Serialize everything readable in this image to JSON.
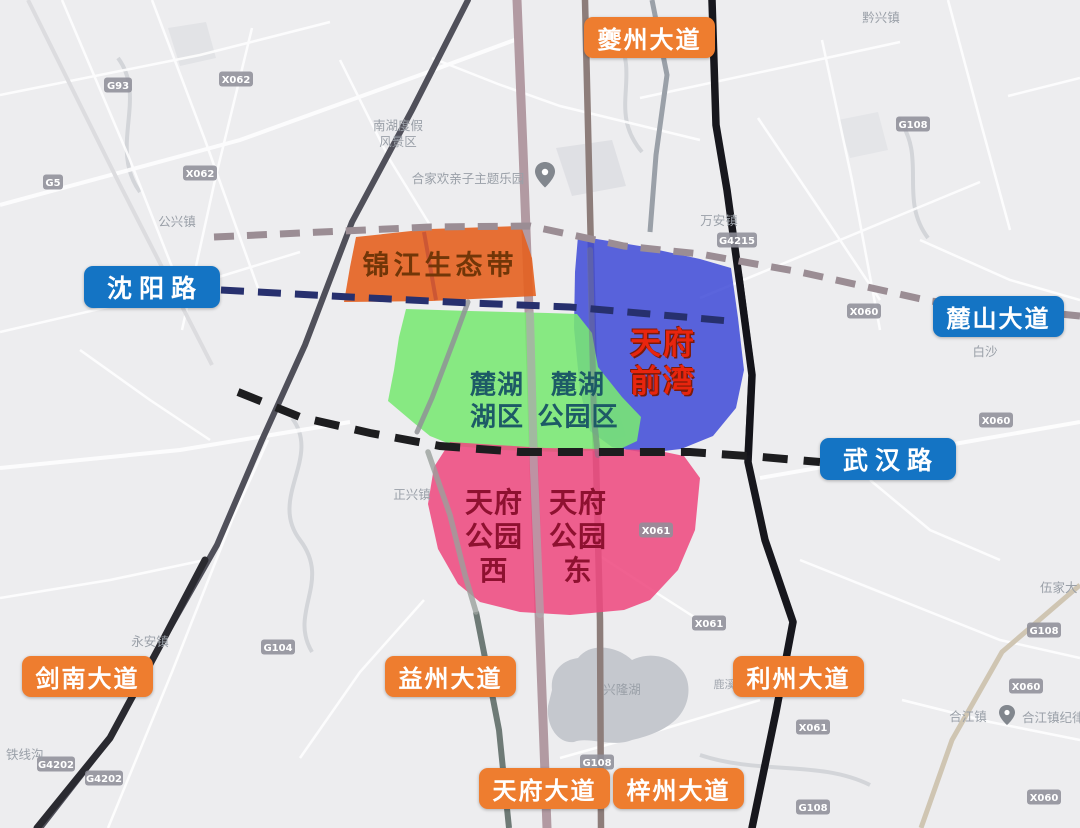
{
  "regions": {
    "jinjiang": {
      "name": "锦江生态带"
    },
    "qianwan": {
      "line1": "天府",
      "line2": "前湾"
    },
    "luhu_lake": {
      "line1": "麓湖",
      "line2": "湖区"
    },
    "luhu_park": {
      "line1": "麓湖",
      "line2": "公园区"
    },
    "park_west": {
      "line1": "天府",
      "line2": "公园",
      "line3": "西"
    },
    "park_east": {
      "line1": "天府",
      "line2": "公园",
      "line3": "东"
    }
  },
  "road_labels": {
    "kuizhou": "夔州大道",
    "shenyang": "沈阳路",
    "lushan": "麓山大道",
    "wuhan": "武汉路",
    "jiannan": "剑南大道",
    "yizhou": "益州大道",
    "lizhou": "利州大道",
    "tianfu": "天府大道",
    "zizhou": "梓州大道"
  },
  "towns": {
    "qianxing": "黔兴镇",
    "gongxing": "公兴镇",
    "wanan": "万安镇",
    "zhengxing": "正兴镇",
    "yongan": "永安镇",
    "hejiang": "合江镇",
    "baisha": "白沙",
    "tiexian": "铁线沟",
    "wujia": "伍家大"
  },
  "pois": {
    "theme_park": "合家欢亲子主题乐园",
    "nanhu_l1": "南湖度假",
    "nanhu_l2": "风景区",
    "hejiang_committee": "合江镇纪律检查",
    "xinglong_lake": "兴隆湖",
    "luxi_river": "鹿溪河"
  },
  "shields": {
    "g93": "G93",
    "x062": "X062",
    "g5": "G5",
    "g108": "G108",
    "g4215": "G4215",
    "x061": "X061",
    "x060": "X060",
    "g104": "G104",
    "g4202": "G4202"
  },
  "colors": {
    "orange_pill": "#ee7d2f",
    "blue_pill": "#1474c4",
    "region_orange": "#e4601f",
    "region_blue": "#3c48d6",
    "region_green": "#79e873",
    "region_pink": "#ee4a80",
    "dash_mauve": "#9b8d94",
    "dash_navy": "#27306e",
    "dash_black": "#1d1d1f"
  }
}
